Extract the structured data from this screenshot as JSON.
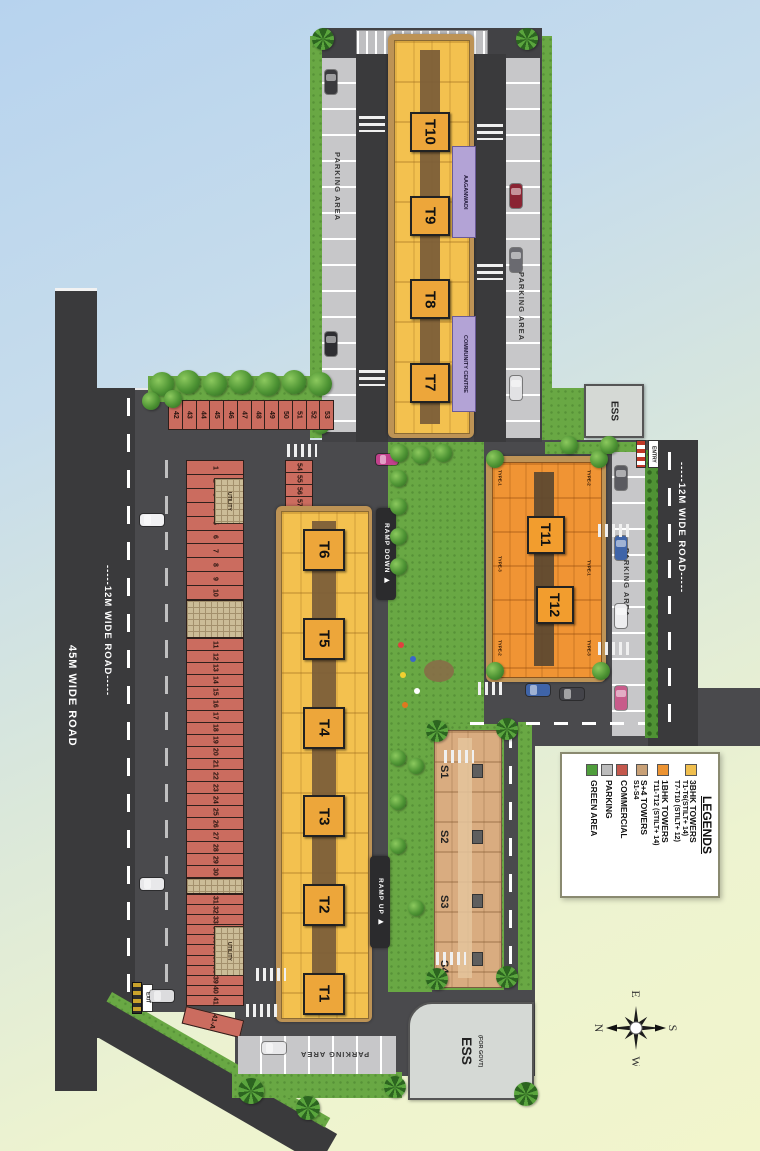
{
  "roads": {
    "r45": "45M WIDE ROAD",
    "l12": "-----12M WIDE ROAD-----",
    "r12": "-----12M WIDE ROAD-----"
  },
  "parking": {
    "label": "PARKING AREA"
  },
  "gates": {
    "entry": "ENTRY",
    "exit": "EXIT"
  },
  "ramps": {
    "down": "RAMP DOWN ▶",
    "up": "RAMP UP ▶"
  },
  "towers_top": [
    "T10",
    "T9",
    "T8",
    "T7"
  ],
  "towers_main": [
    "T6",
    "T5",
    "T4",
    "T3",
    "T2",
    "T1"
  ],
  "towers_1bhk": [
    "T11",
    "T12"
  ],
  "towers_s": [
    "S1",
    "S2",
    "S3",
    "S4"
  ],
  "facilities": {
    "aganwadi": "AAGANWADI",
    "community": "COMMUNITY CENTRE",
    "ess": "ESS",
    "ess_govt": "ESS",
    "ess_govt_sub": "(FOR GOVT)",
    "utility": "UTILITY"
  },
  "strip_nums_a1": [
    "1",
    "2",
    "3",
    "4",
    "5",
    "6",
    "7",
    "8",
    "9",
    "10"
  ],
  "strip_nums_a2": [
    "11",
    "12",
    "13",
    "14",
    "15",
    "16",
    "17",
    "18",
    "19",
    "20",
    "21",
    "22",
    "23",
    "24",
    "25",
    "26",
    "27",
    "28",
    "29",
    "30"
  ],
  "strip_nums_a3": [
    "31",
    "32",
    "33",
    "34",
    "35",
    "36",
    "37",
    "38",
    "39",
    "40",
    "41"
  ],
  "strip_last": "41-A",
  "strip_nums_top": [
    "42",
    "43",
    "44",
    "45",
    "46",
    "47",
    "48",
    "49",
    "50",
    "51",
    "52",
    "53"
  ],
  "strip_nums_side": [
    "54",
    "55",
    "56",
    "57",
    "58",
    "59",
    "60"
  ],
  "unit_types": [
    "TYPE-1",
    "TYPE-2",
    "TYPE-3"
  ],
  "legend": {
    "title": "LEGENDS",
    "items": [
      {
        "color": "#f0bf4e",
        "lines": [
          "3BHK TOWERS",
          "T1-T6(STILT+ 14)",
          "T7-T10 (STILT+ 12)"
        ]
      },
      {
        "color": "#ed9433",
        "lines": [
          "1BHK TOWERS",
          "T11-T12 (STILT+ 14)"
        ]
      },
      {
        "color": "#c9a177",
        "lines": [
          "S+4 TOWERS",
          "S1-S4"
        ]
      },
      {
        "color": "#c4584d",
        "lines": [
          "COMMERCIAL"
        ]
      },
      {
        "color": "#bcbcbc",
        "lines": [
          "PARKING"
        ]
      },
      {
        "color": "#4f9e3c",
        "lines": [
          "GREEN AREA"
        ]
      }
    ]
  },
  "compass": {
    "up": "E",
    "left": "N",
    "right": "S",
    "down": "W"
  }
}
